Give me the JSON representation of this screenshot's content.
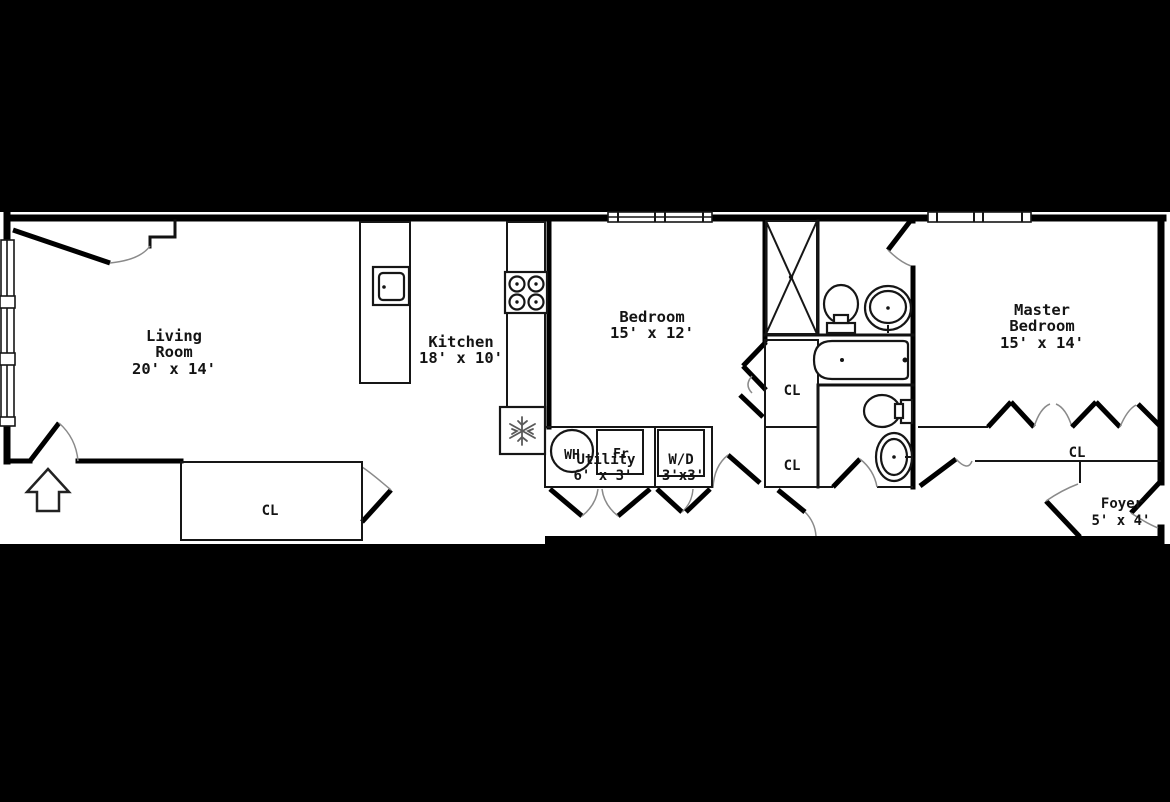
{
  "meta": {
    "type": "apartment-floor-plan",
    "colors": {
      "background": "#000000",
      "floor": "#ffffff",
      "walls": "#000000",
      "text": "#141414"
    }
  },
  "rooms": {
    "living": {
      "line1": "Living",
      "line2": "Room",
      "dims": "20' x 14'"
    },
    "kitchen": {
      "line1": "Kitchen",
      "dims": "18' x 10'"
    },
    "bedroom": {
      "line1": "Bedroom",
      "dims": "15' x 12'"
    },
    "master": {
      "line1": "Master",
      "line2": "Bedroom",
      "dims": "15' x 14'"
    },
    "utility": {
      "line1": "Utility",
      "dims": "6' x 3'"
    },
    "wd": {
      "line1": "W/D",
      "dims": "3'x3'"
    },
    "foyer": {
      "line1": "Foyer",
      "dims": "5' x 4'"
    }
  },
  "closets": {
    "living_cl": "CL",
    "hall_cl_upper": "CL",
    "hall_cl_lower": "CL",
    "master_cl": "CL"
  },
  "fixtures": {
    "water_heater": "WH",
    "small_fridge": "Fr"
  },
  "icons": [
    "entry-arrow-icon",
    "kitchen-island-sink-icon",
    "stove-icon",
    "fridge-snowflake-icon",
    "shower-icon",
    "toilet-icon",
    "bathroom-sink-icon",
    "bathtub-icon",
    "water-heater-icon"
  ]
}
